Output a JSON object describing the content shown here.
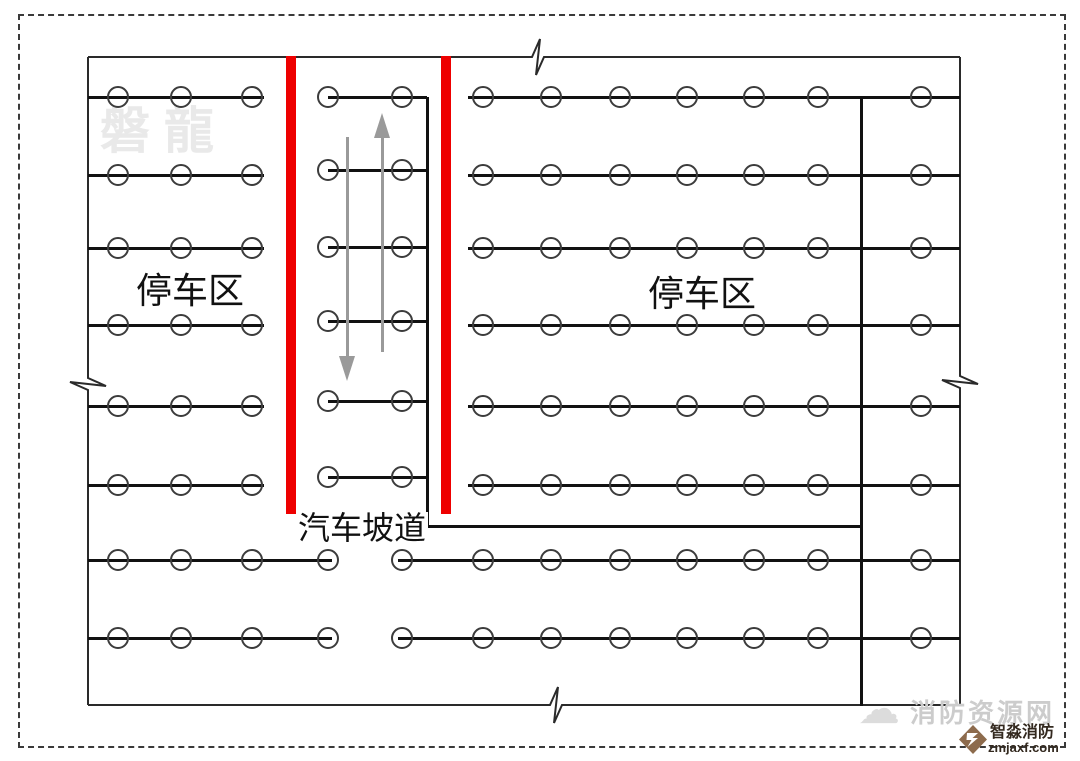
{
  "labels": {
    "left_parking": {
      "text": "停车区"
    },
    "right_parking": {
      "text": "停车区"
    },
    "ramp": {
      "text": "汽车坡道"
    },
    "watermark": {
      "text": "磐龍"
    }
  },
  "footer": {
    "site_name": "消防资源网",
    "brand_name": "智淼消防",
    "brand_domain": "zmjaxf.com",
    "cloud_icon": "☁"
  },
  "colors": {
    "ramp_wall_red": "#ee0000",
    "pipe_black": "#111111",
    "wall_black": "#2a2a2a",
    "arrow_gray": "#9a9a9a",
    "watermark_gray": "#e9e9e9",
    "logo_brown": "#8d6b4d"
  },
  "geometry": {
    "canvas": {
      "w": 1080,
      "h": 761
    },
    "border": {
      "x": 18,
      "y": 14,
      "w": 1044,
      "h": 730
    },
    "walls": [
      {
        "name": "top-wall",
        "orient": "h",
        "pos": 57,
        "from": 88,
        "to": 960,
        "break_at": 538
      },
      {
        "name": "bottom-wall",
        "orient": "h",
        "pos": 705,
        "from": 88,
        "to": 960,
        "break_at": 556
      },
      {
        "name": "left-wall",
        "orient": "v",
        "pos": 88,
        "from": 57,
        "to": 705,
        "break_at": 384
      },
      {
        "name": "right-wall",
        "orient": "v",
        "pos": 960,
        "from": 57,
        "to": 705,
        "break_at": 382
      }
    ],
    "pipes": [
      {
        "name": "ramp-main-pipe",
        "orient": "v",
        "pos": 427,
        "from": 97,
        "to": 528
      },
      {
        "name": "ramp-connector-pipe",
        "orient": "h",
        "pos": 526,
        "from": 427,
        "to": 863
      },
      {
        "name": "right-main-pipe",
        "orient": "v",
        "pos": 861,
        "from": 97,
        "to": 706
      }
    ],
    "sprinkler_rows": [
      {
        "area": "left-parking",
        "y_list": [
          97,
          175,
          248,
          325,
          406,
          485
        ],
        "line": [
          88,
          264
        ],
        "circles_x": [
          118,
          181,
          252
        ]
      },
      {
        "area": "ramp",
        "y_list": [
          97,
          170,
          247,
          321,
          401,
          477
        ],
        "line": [
          328,
          427
        ],
        "circles_x": [
          328,
          402
        ]
      },
      {
        "area": "right-parking",
        "y_list": [
          97,
          175,
          248,
          325,
          406,
          485
        ],
        "line": [
          468,
          960
        ],
        "circles_x": [
          483,
          551,
          620,
          687,
          754,
          818,
          921
        ]
      },
      {
        "area": "bottom-left",
        "y_list": [
          560,
          638
        ],
        "line": [
          88,
          332
        ],
        "circles_x": [
          118,
          181,
          252,
          328
        ]
      },
      {
        "area": "bottom-right",
        "y_list": [
          560,
          638
        ],
        "line": [
          398,
          960
        ],
        "circles_x": [
          402,
          483,
          551,
          620,
          687,
          754,
          818,
          921
        ]
      }
    ],
    "circle_diameter": 22,
    "red_bars": [
      {
        "name": "ramp-wall-left",
        "x": 286,
        "y": 56,
        "w": 10,
        "h": 458
      },
      {
        "name": "ramp-wall-right",
        "x": 441,
        "y": 56,
        "w": 10,
        "h": 458
      }
    ],
    "arrows": [
      {
        "name": "ramp-arrow-down",
        "dir": "down",
        "x": 347,
        "line_from": 137,
        "line_to": 356,
        "head_len": 25,
        "head_w": 16
      },
      {
        "name": "ramp-arrow-up",
        "dir": "up",
        "x": 382,
        "line_from": 138,
        "line_to": 352,
        "head_len": 25,
        "head_w": 16
      }
    ]
  }
}
